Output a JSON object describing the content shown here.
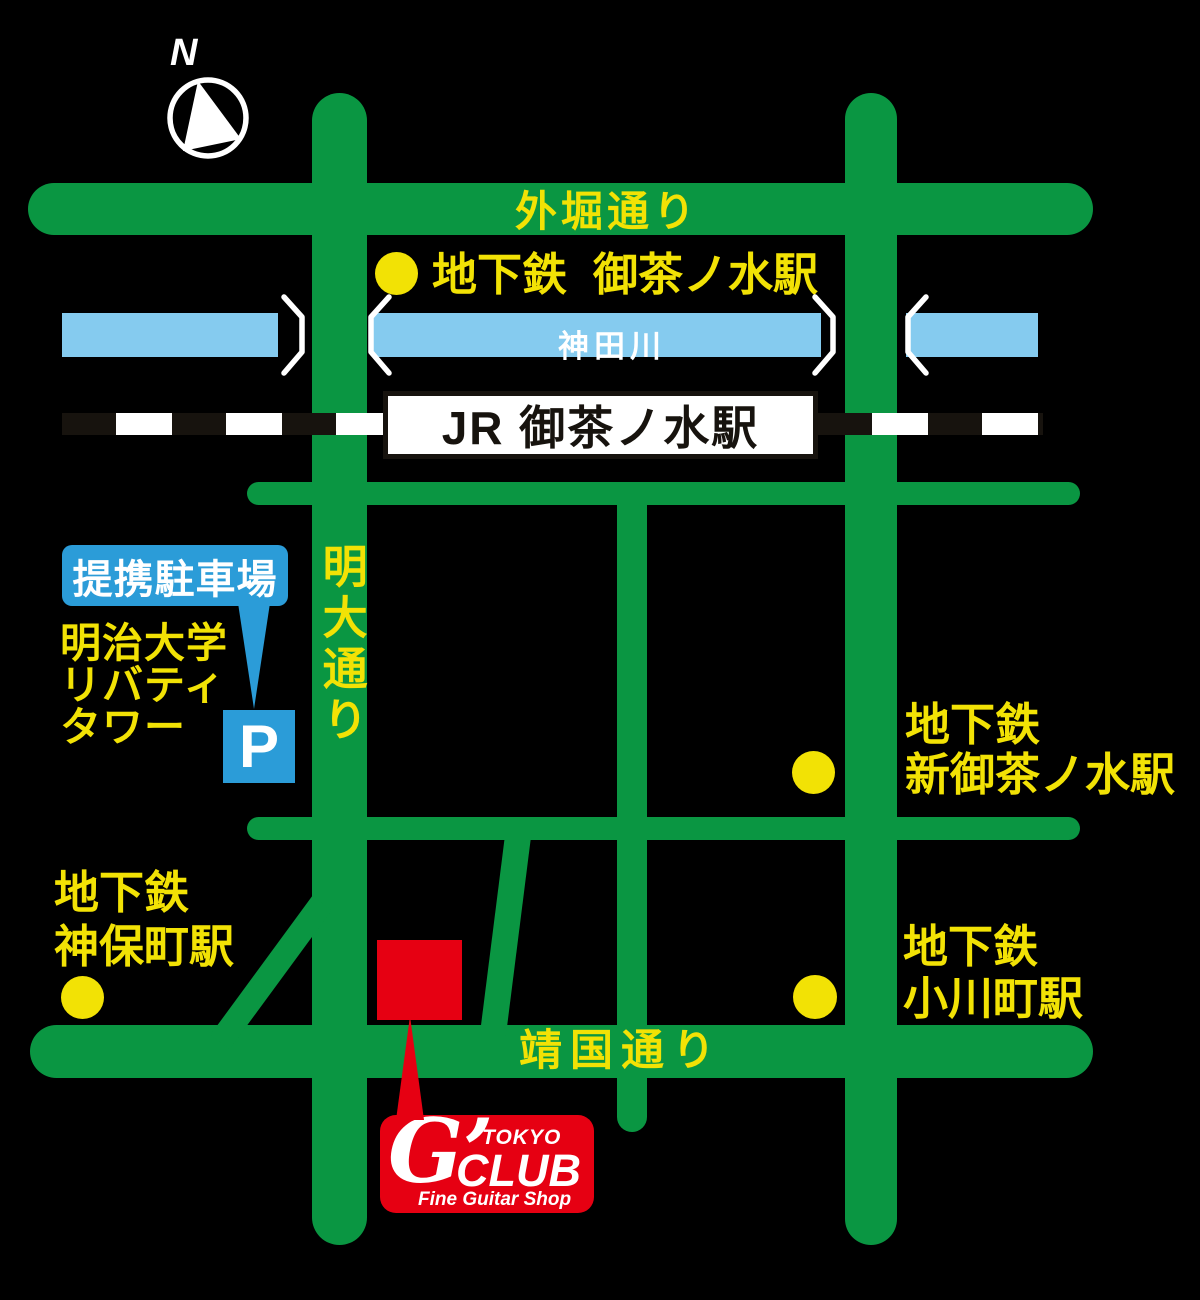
{
  "compass": {
    "label": "N"
  },
  "roads": {
    "sotobori_dori": "外堀通り",
    "meidai_dori": "明大通り",
    "yasukuni_dori": "靖国通り"
  },
  "river": {
    "name": "神田川"
  },
  "jr_station": {
    "name": "JR 御茶ノ水駅"
  },
  "subway_stations": {
    "ochanomizu": {
      "prefix": "地下鉄",
      "name": "御茶ノ水駅"
    },
    "shin_ochanomizu": {
      "line1": "地下鉄",
      "line2": "新御茶ノ水駅"
    },
    "jimbocho": {
      "line1": "地下鉄",
      "line2": "神保町駅"
    },
    "ogawamachi": {
      "line1": "地下鉄",
      "line2": "小川町駅"
    }
  },
  "parking": {
    "label": "提携駐車場",
    "building": [
      "明治大学",
      "リバティ",
      "タワー"
    ],
    "symbol": "P"
  },
  "shop": {
    "brand_g": "G’",
    "brand_city": "TOKYO",
    "brand_club": "CLUB",
    "tagline": "Fine Guitar Shop"
  },
  "colors": {
    "background": "#000000",
    "road_green": "#0A9642",
    "river_blue": "#85CBEF",
    "label_yellow": "#F2E205",
    "parking_blue": "#2B9CD8",
    "brand_red": "#E60012",
    "railway_dark": "#17130E",
    "white": "#FFFFFF"
  }
}
